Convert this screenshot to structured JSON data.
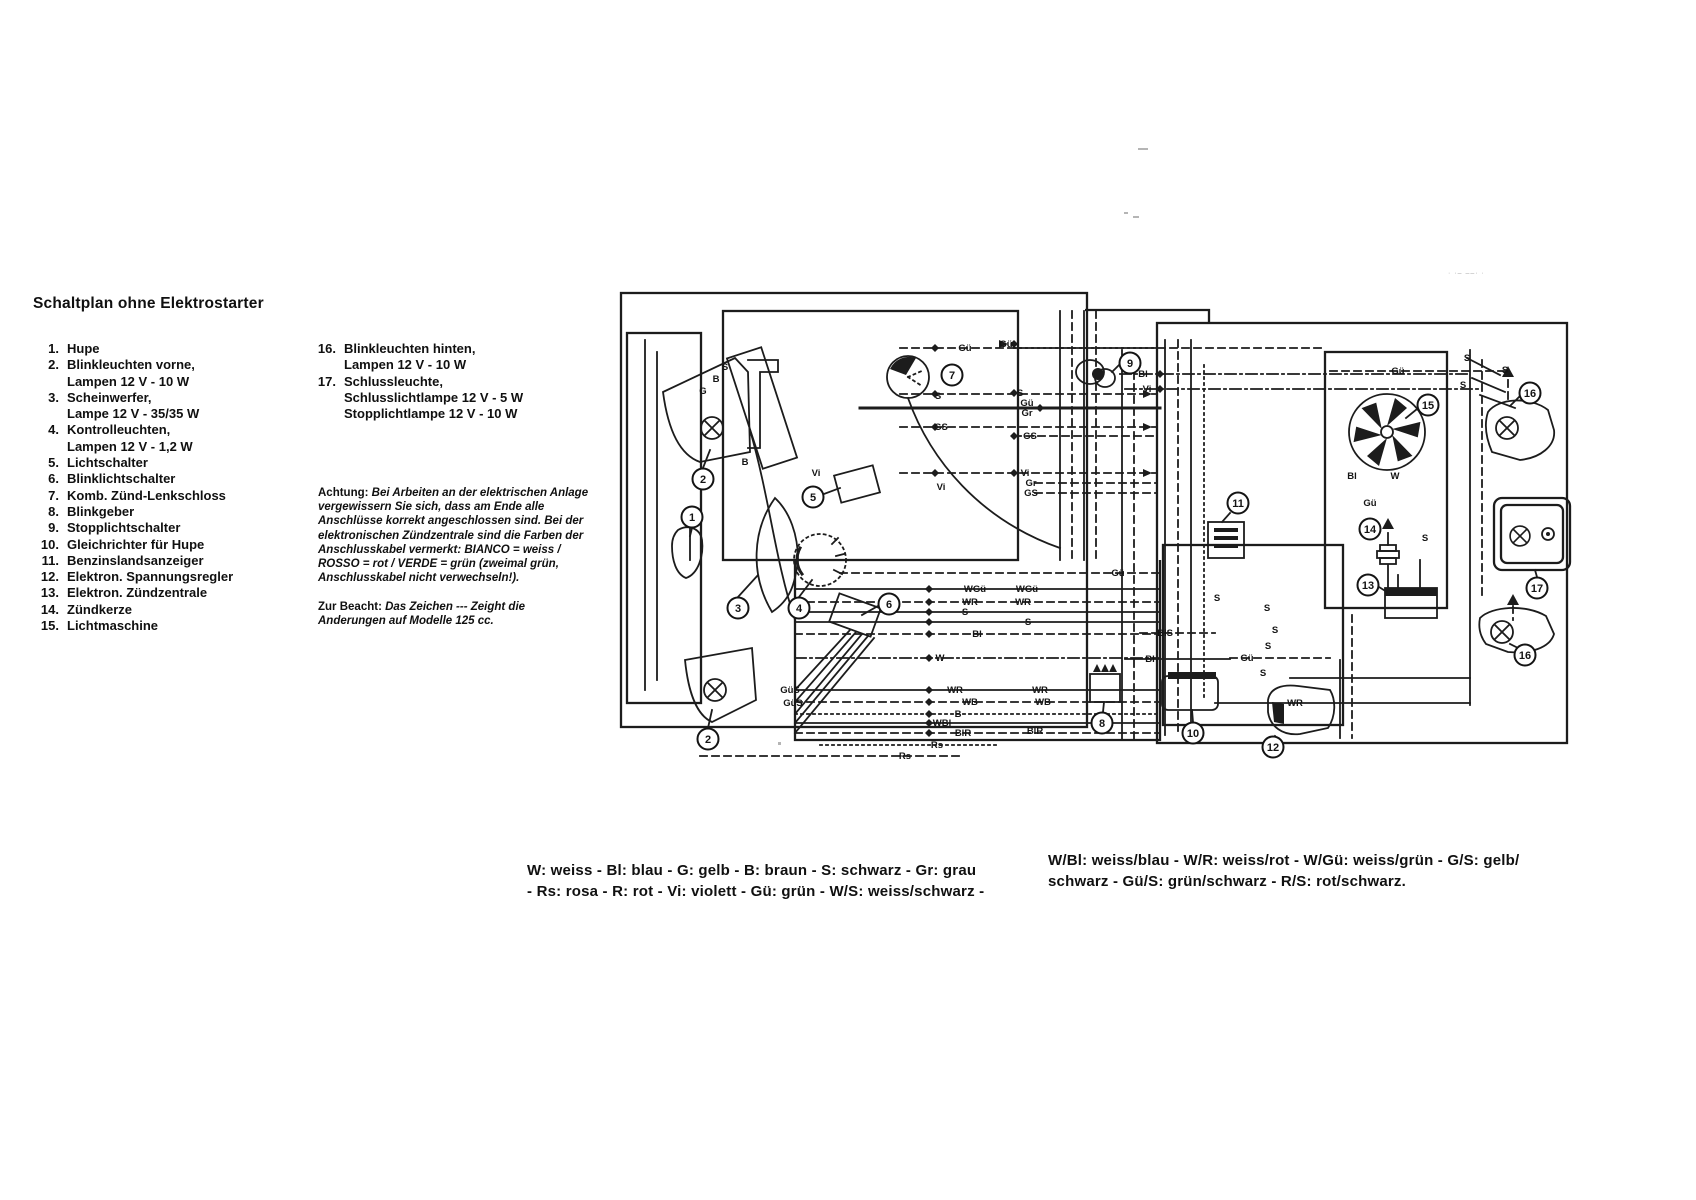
{
  "page": {
    "title": "Schaltplan ohne Elektrostarter",
    "corner_noise": "· ·– ––· ·",
    "legend_left": [
      {
        "num": "1.",
        "lines": [
          "Hupe"
        ]
      },
      {
        "num": "2.",
        "lines": [
          "Blinkleuchten vorne,",
          "Lampen 12 V - 10 W"
        ]
      },
      {
        "num": "3.",
        "lines": [
          "Scheinwerfer,",
          "Lampe 12 V - 35/35 W"
        ]
      },
      {
        "num": "4.",
        "lines": [
          "Kontrolleuchten,",
          "Lampen 12 V - 1,2 W"
        ]
      },
      {
        "num": "5.",
        "lines": [
          "Lichtschalter"
        ]
      },
      {
        "num": "6.",
        "lines": [
          "Blinklichtschalter"
        ]
      },
      {
        "num": "7.",
        "lines": [
          "Komb. Zünd-Lenkschloss"
        ]
      },
      {
        "num": "8.",
        "lines": [
          "Blinkgeber"
        ]
      },
      {
        "num": "9.",
        "lines": [
          "Stopplichtschalter"
        ]
      },
      {
        "num": "10.",
        "lines": [
          "Gleichrichter für Hupe"
        ]
      },
      {
        "num": "11.",
        "lines": [
          "Benzinslandsanzeiger"
        ]
      },
      {
        "num": "12.",
        "lines": [
          "Elektron. Spannungsregler"
        ]
      },
      {
        "num": "13.",
        "lines": [
          "Elektron. Zündzentrale"
        ]
      },
      {
        "num": "14.",
        "lines": [
          "Zündkerze"
        ]
      },
      {
        "num": "15.",
        "lines": [
          "Lichtmaschine"
        ]
      }
    ],
    "legend_right": [
      {
        "num": "16.",
        "lines": [
          "Blinkleuchten hinten,",
          "Lampen 12 V - 10 W"
        ]
      },
      {
        "num": "17.",
        "lines": [
          "Schlussleuchte,",
          "Schlusslichtlampe 12 V - 5 W",
          "Stopplichtlampe 12 V - 10 W"
        ]
      }
    ],
    "achtung_label": "Achtung:",
    "achtung_text": " Bei Arbeiten an der elektrischen Anlage vergewissern Sie sich, dass am Ende alle Anschlüsse korrekt angeschlossen sind. Bei der elektronischen Zündzentrale sind die Farben der Anschlusskabel vermerkt: BIANCO = weiss / ROSSO = rot / VERDE = grün (zweimal grün, Anschlusskabel nicht verwechseln!).",
    "beacht_label": "Zur Beacht:",
    "beacht_text": " Das Zeichen --- Zeight die Anderungen auf Modelle 125 cc.",
    "color_legend_left": [
      "W: weiss - Bl: blau - G: gelb - B: braun - S: schwarz - Gr: grau",
      "- Rs: rosa - R: rot - Vi: violett - Gü: grün - W/S: weiss/schwarz -"
    ],
    "color_legend_right": [
      "W/Bl: weiss/blau - W/R: weiss/rot - W/Gü: weiss/grün - G/S: gelb/",
      "schwarz - Gü/S: grün/schwarz - R/S: rot/schwarz."
    ]
  },
  "diagram": {
    "callouts": [
      {
        "n": "1",
        "x": 692,
        "y": 517
      },
      {
        "n": "2",
        "x": 703,
        "y": 479
      },
      {
        "n": "2",
        "x": 708,
        "y": 739
      },
      {
        "n": "3",
        "x": 738,
        "y": 608
      },
      {
        "n": "4",
        "x": 799,
        "y": 608
      },
      {
        "n": "5",
        "x": 813,
        "y": 497
      },
      {
        "n": "6",
        "x": 889,
        "y": 604
      },
      {
        "n": "7",
        "x": 952,
        "y": 375
      },
      {
        "n": "8",
        "x": 1102,
        "y": 723
      },
      {
        "n": "9",
        "x": 1130,
        "y": 363
      },
      {
        "n": "10",
        "x": 1193,
        "y": 733
      },
      {
        "n": "11",
        "x": 1238,
        "y": 503
      },
      {
        "n": "12",
        "x": 1273,
        "y": 747
      },
      {
        "n": "13",
        "x": 1368,
        "y": 585
      },
      {
        "n": "14",
        "x": 1370,
        "y": 529
      },
      {
        "n": "15",
        "x": 1428,
        "y": 405
      },
      {
        "n": "16",
        "x": 1530,
        "y": 393
      },
      {
        "n": "17",
        "x": 1537,
        "y": 588
      },
      {
        "n": "16",
        "x": 1525,
        "y": 655
      }
    ],
    "wire_labels": [
      {
        "t": "Gü",
        "x": 965,
        "y": 348
      },
      {
        "t": "Gü",
        "x": 1006,
        "y": 344
      },
      {
        "t": "S",
        "x": 938,
        "y": 396
      },
      {
        "t": "S",
        "x": 1020,
        "y": 393
      },
      {
        "t": "Gü",
        "x": 1027,
        "y": 403
      },
      {
        "t": "Gr",
        "x": 1027,
        "y": 413
      },
      {
        "t": "GS",
        "x": 941,
        "y": 427
      },
      {
        "t": "GS",
        "x": 1030,
        "y": 436
      },
      {
        "t": "Vi",
        "x": 941,
        "y": 487
      },
      {
        "t": "Vi",
        "x": 1025,
        "y": 473
      },
      {
        "t": "Gr",
        "x": 1031,
        "y": 483
      },
      {
        "t": "GS",
        "x": 1031,
        "y": 493
      },
      {
        "t": "S",
        "x": 725,
        "y": 367
      },
      {
        "t": "B",
        "x": 716,
        "y": 379
      },
      {
        "t": "G",
        "x": 703,
        "y": 391
      },
      {
        "t": "B",
        "x": 745,
        "y": 462
      },
      {
        "t": "Vi",
        "x": 816,
        "y": 473
      },
      {
        "t": "Bl",
        "x": 1143,
        "y": 374
      },
      {
        "t": "Vi",
        "x": 1147,
        "y": 389
      },
      {
        "t": "Gü",
        "x": 1118,
        "y": 573
      },
      {
        "t": "WGü",
        "x": 975,
        "y": 589
      },
      {
        "t": "WGü",
        "x": 1027,
        "y": 589
      },
      {
        "t": "WR",
        "x": 970,
        "y": 602
      },
      {
        "t": "WR",
        "x": 1023,
        "y": 602
      },
      {
        "t": "S",
        "x": 965,
        "y": 612
      },
      {
        "t": "S",
        "x": 1028,
        "y": 622
      },
      {
        "t": "Bl",
        "x": 977,
        "y": 634
      },
      {
        "t": "W",
        "x": 940,
        "y": 658
      },
      {
        "t": "WR",
        "x": 955,
        "y": 690
      },
      {
        "t": "WR",
        "x": 1040,
        "y": 690
      },
      {
        "t": "WB",
        "x": 970,
        "y": 702
      },
      {
        "t": "WB",
        "x": 1043,
        "y": 702
      },
      {
        "t": "B",
        "x": 958,
        "y": 714
      },
      {
        "t": "WBl",
        "x": 942,
        "y": 723
      },
      {
        "t": "BlR",
        "x": 963,
        "y": 733
      },
      {
        "t": "Rs",
        "x": 937,
        "y": 745
      },
      {
        "t": "Rs",
        "x": 905,
        "y": 756
      },
      {
        "t": "BlS",
        "x": 1165,
        "y": 633
      },
      {
        "t": "Bl",
        "x": 1150,
        "y": 659
      },
      {
        "t": "Gü",
        "x": 1247,
        "y": 658
      },
      {
        "t": "S",
        "x": 1217,
        "y": 598
      },
      {
        "t": "S",
        "x": 1267,
        "y": 608
      },
      {
        "t": "S",
        "x": 1275,
        "y": 630
      },
      {
        "t": "S",
        "x": 1268,
        "y": 646
      },
      {
        "t": "S",
        "x": 1263,
        "y": 673
      },
      {
        "t": "Gü",
        "x": 1398,
        "y": 371
      },
      {
        "t": "Bl",
        "x": 1352,
        "y": 476
      },
      {
        "t": "W",
        "x": 1395,
        "y": 476
      },
      {
        "t": "Gü",
        "x": 1370,
        "y": 503
      },
      {
        "t": "S",
        "x": 1425,
        "y": 538
      },
      {
        "t": "S",
        "x": 1467,
        "y": 358
      },
      {
        "t": "S",
        "x": 1505,
        "y": 370
      },
      {
        "t": "S",
        "x": 1463,
        "y": 385
      },
      {
        "t": "GüS",
        "x": 790,
        "y": 690
      },
      {
        "t": "GüS",
        "x": 793,
        "y": 703
      },
      {
        "t": "WR",
        "x": 1295,
        "y": 703
      },
      {
        "t": "BlR",
        "x": 1035,
        "y": 731
      }
    ]
  }
}
